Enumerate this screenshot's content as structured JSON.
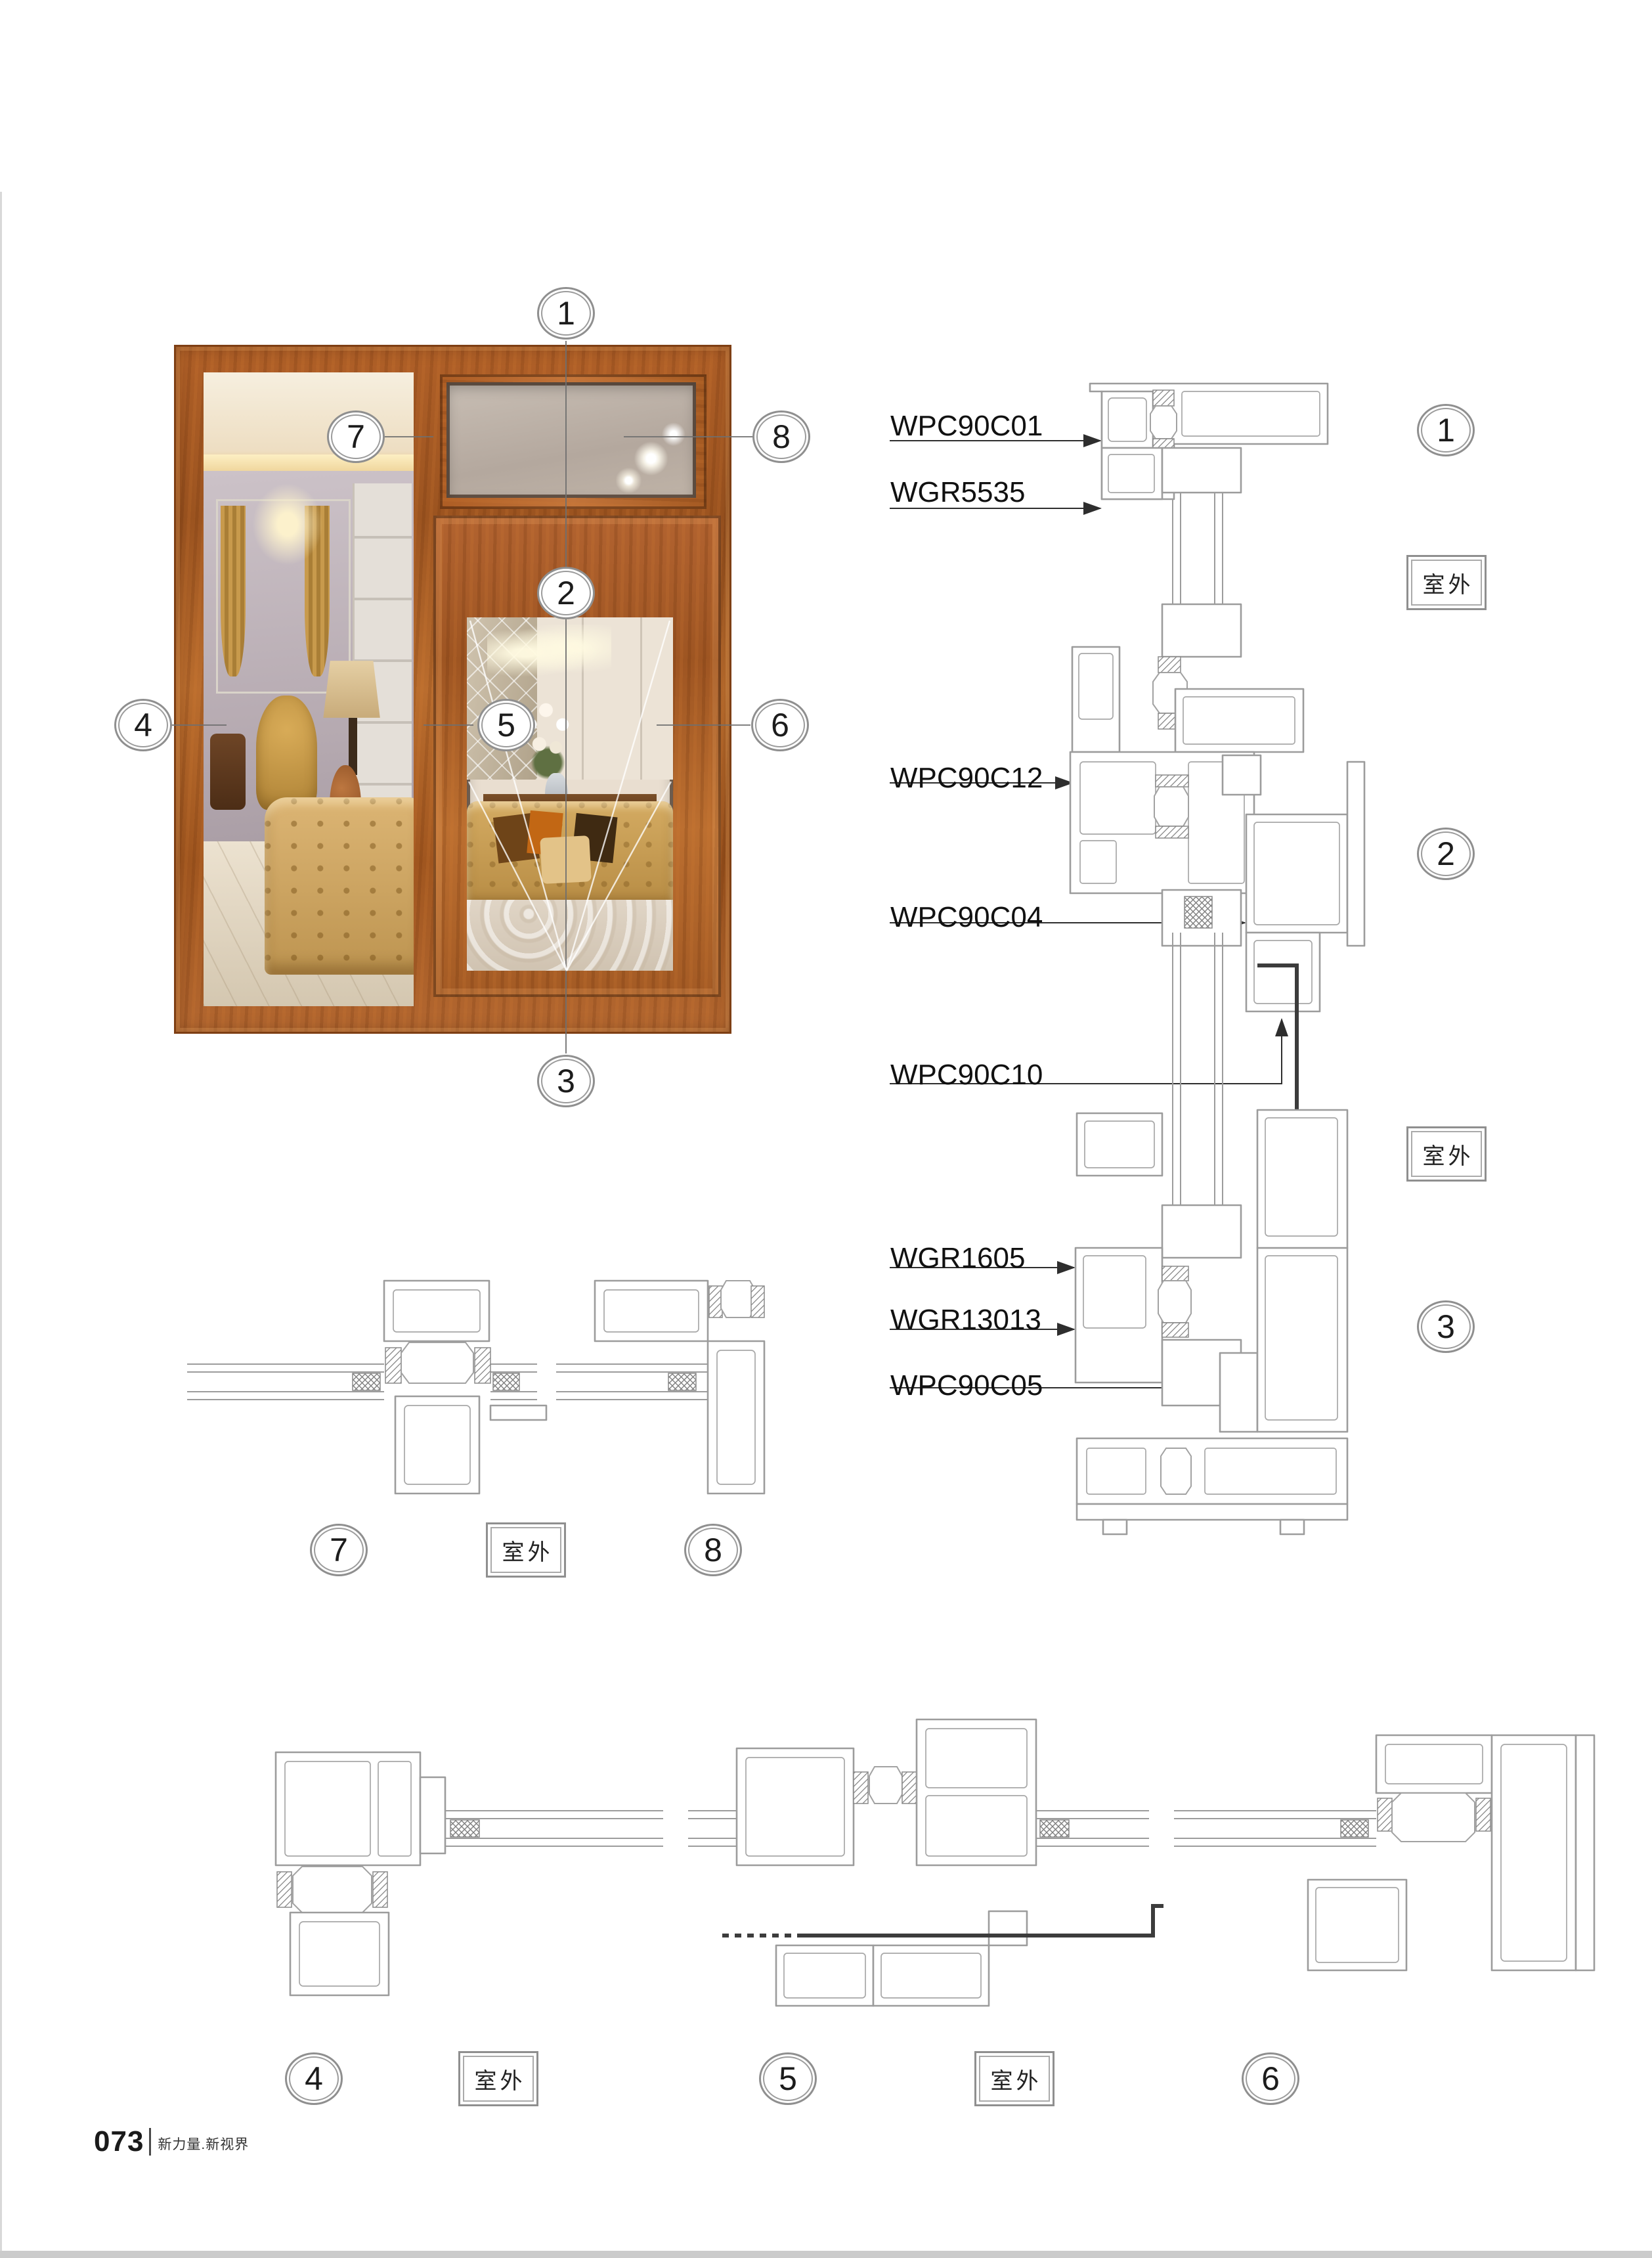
{
  "page": {
    "footer_page_number": "073",
    "footer_tagline": "新力量.新视界"
  },
  "outdoor_label": "室外",
  "photo_callouts": [
    "1",
    "2",
    "3",
    "4",
    "5",
    "6",
    "7",
    "8"
  ],
  "right_column": {
    "part_labels": [
      "WPC90C01",
      "WGR5535",
      "WPC90C12",
      "WPC90C04",
      "WPC90C10",
      "WGR1605",
      "WGR13013",
      "WPC90C05"
    ],
    "callouts": [
      "1",
      "2",
      "3"
    ],
    "outdoor_boxes": [
      "室外",
      "室外"
    ]
  },
  "mid_row": {
    "callouts": [
      "7",
      "8"
    ],
    "outdoor_boxes": [
      "室外"
    ]
  },
  "bottom_row": {
    "callouts": [
      "4",
      "5",
      "6"
    ],
    "outdoor_boxes": [
      "室外",
      "室外"
    ]
  }
}
